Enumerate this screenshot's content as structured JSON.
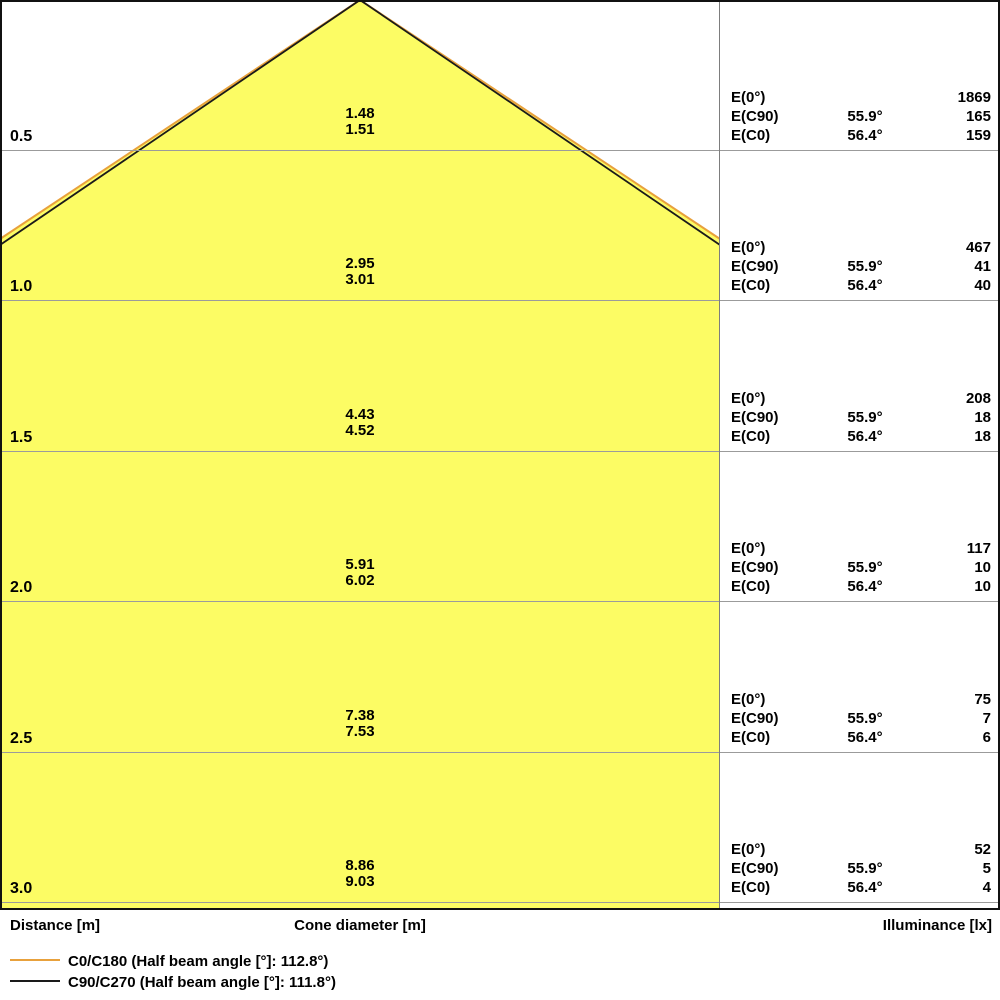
{
  "colors": {
    "cone_fill": "#FCFC64",
    "c0_c180_line": "#E8A13C",
    "c90_c270_line": "#1A1A1A",
    "grid_line": "#9B9B9B",
    "border": "#111111"
  },
  "axis": {
    "distance_label": "Distance [m]",
    "cone_diameter_label": "Cone diameter [m]",
    "illuminance_label": "Illuminance [lx]"
  },
  "table": {
    "e0_label": "E(0°)",
    "ec90_label": "E(C90)",
    "ec0_label": "E(C0)",
    "ec90_angle": "55.9°",
    "ec0_angle": "56.4°"
  },
  "rows": [
    {
      "distance": "0.5",
      "cone_c90": "1.48",
      "cone_c0": "1.51",
      "e0": "1869",
      "ec90": "165",
      "ec0": "159"
    },
    {
      "distance": "1.0",
      "cone_c90": "2.95",
      "cone_c0": "3.01",
      "e0": "467",
      "ec90": "41",
      "ec0": "40"
    },
    {
      "distance": "1.5",
      "cone_c90": "4.43",
      "cone_c0": "4.52",
      "e0": "208",
      "ec90": "18",
      "ec0": "18"
    },
    {
      "distance": "2.0",
      "cone_c90": "5.91",
      "cone_c0": "6.02",
      "e0": "117",
      "ec90": "10",
      "ec0": "10"
    },
    {
      "distance": "2.5",
      "cone_c90": "7.38",
      "cone_c0": "7.53",
      "e0": "75",
      "ec90": "7",
      "ec0": "6"
    },
    {
      "distance": "3.0",
      "cone_c90": "8.86",
      "cone_c0": "9.03",
      "e0": "52",
      "ec90": "5",
      "ec0": "4"
    }
  ],
  "legend": {
    "items": [
      {
        "label": "C0/C180 (Half beam angle [°]: 112.8°)",
        "color": "#E8A13C"
      },
      {
        "label": "C90/C270 (Half beam angle [°]: 111.8°)",
        "color": "#1A1A1A"
      }
    ]
  },
  "chart_data": {
    "type": "area",
    "title": "Light cone diagram",
    "xlabel": "Distance [m]",
    "ylabel_left": "Cone diameter [m]",
    "ylabel_right": "Illuminance [lx]",
    "distances_m": [
      0.5,
      1.0,
      1.5,
      2.0,
      2.5,
      3.0
    ],
    "series": [
      {
        "name": "C0/C180",
        "half_beam_angle_label_deg": 112.8,
        "cone_angle_deg": 56.4,
        "cone_diameter_m": [
          1.51,
          3.01,
          4.52,
          6.02,
          7.53,
          9.03
        ],
        "illuminance_lx": [
          159,
          40,
          18,
          10,
          6,
          4
        ],
        "color": "#E8A13C"
      },
      {
        "name": "C90/C270",
        "half_beam_angle_label_deg": 111.8,
        "cone_angle_deg": 55.9,
        "cone_diameter_m": [
          1.48,
          2.95,
          4.43,
          5.91,
          7.38,
          8.86
        ],
        "illuminance_lx": [
          165,
          41,
          18,
          10,
          7,
          5
        ],
        "color": "#1A1A1A"
      },
      {
        "name": "E(0°)",
        "illuminance_lx": [
          1869,
          467,
          208,
          117,
          75,
          52
        ]
      }
    ],
    "legend_position": "bottom-left",
    "grid": true
  }
}
